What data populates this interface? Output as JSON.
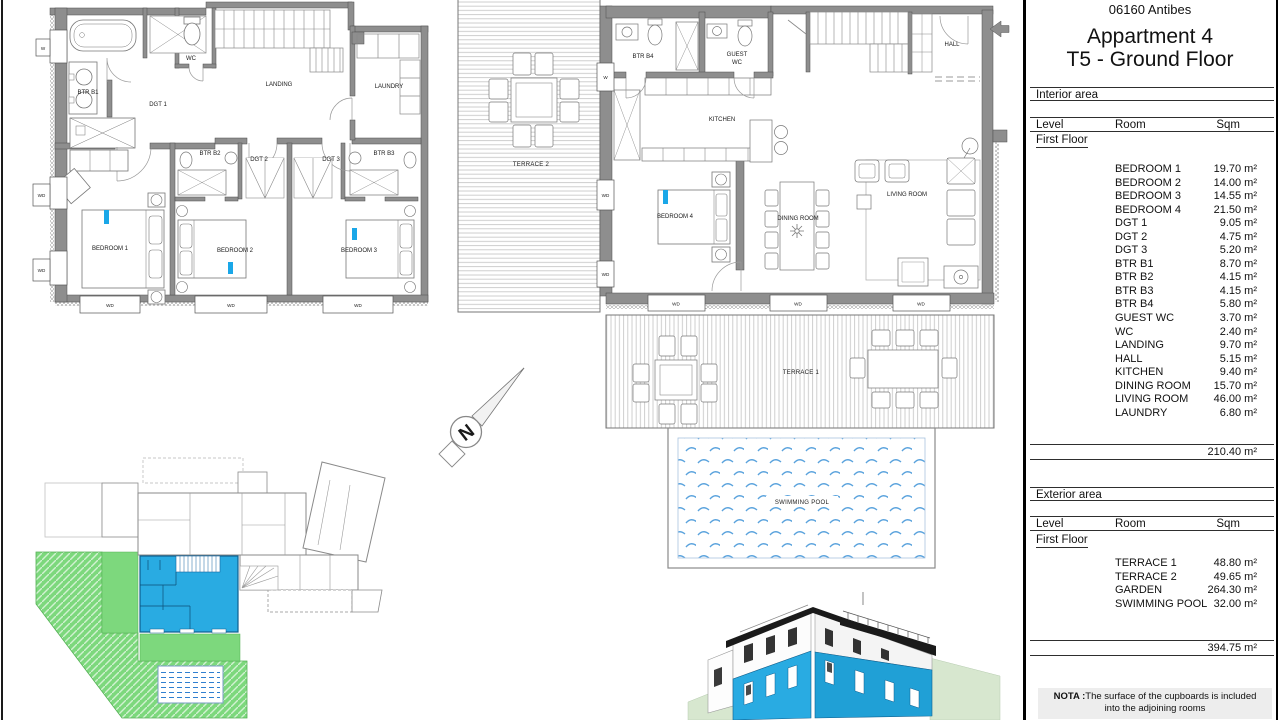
{
  "panel": {
    "location": "06160 Antibes",
    "title_line1": "Appartment 4",
    "title_line2": "T5 - Ground Floor",
    "interior": {
      "section": "Interior area",
      "columns": {
        "level": "Level",
        "room": "Room",
        "sqm": "Sqm"
      },
      "level": "First Floor",
      "rows": [
        {
          "room": "BEDROOM 1",
          "sqm": "19.70 m²"
        },
        {
          "room": "BEDROOM 2",
          "sqm": "14.00 m²"
        },
        {
          "room": "BEDROOM 3",
          "sqm": "14.55 m²"
        },
        {
          "room": "BEDROOM 4",
          "sqm": "21.50 m²"
        },
        {
          "room": "DGT 1",
          "sqm": "9.05 m²"
        },
        {
          "room": "DGT 2",
          "sqm": "4.75 m²"
        },
        {
          "room": "DGT 3",
          "sqm": "5.20 m²"
        },
        {
          "room": "BTR B1",
          "sqm": "8.70 m²"
        },
        {
          "room": "BTR B2",
          "sqm": "4.15 m²"
        },
        {
          "room": "BTR B3",
          "sqm": "4.15 m²"
        },
        {
          "room": "BTR B4",
          "sqm": "5.80 m²"
        },
        {
          "room": "GUEST WC",
          "sqm": "3.70 m²"
        },
        {
          "room": "WC",
          "sqm": "2.40 m²"
        },
        {
          "room": "LANDING",
          "sqm": "9.70 m²"
        },
        {
          "room": "HALL",
          "sqm": "5.15 m²"
        },
        {
          "room": "KITCHEN",
          "sqm": "9.40 m²"
        },
        {
          "room": "DINING ROOM",
          "sqm": "15.70 m²"
        },
        {
          "room": "LIVING ROOM",
          "sqm": "46.00 m²"
        },
        {
          "room": "LAUNDRY",
          "sqm": "6.80 m²"
        }
      ],
      "total": "210.40 m²"
    },
    "exterior": {
      "section": "Exterior area",
      "columns": {
        "level": "Level",
        "room": "Room",
        "sqm": "Sqm"
      },
      "level": "First Floor",
      "rows": [
        {
          "room": "TERRACE 1",
          "sqm": "48.80 m²"
        },
        {
          "room": "TERRACE 2",
          "sqm": "49.65 m²"
        },
        {
          "room": "GARDEN",
          "sqm": "264.30 m²"
        },
        {
          "room": "SWIMMING POOL",
          "sqm": "32.00 m²"
        }
      ],
      "total": "394.75 m²"
    },
    "nota": {
      "label": "NOTA :",
      "text": "The surface of the cupboards is included into the adjoining rooms"
    }
  },
  "plan_upper": {
    "btr_b1": "BTR B1",
    "wc": "WC",
    "landing": "LANDING",
    "laundry": "LAUNDRY",
    "dgt1": "DGT 1",
    "btr_b2": "BTR B2",
    "dgt2": "DGT 2",
    "dgt3": "DGT 3",
    "btr_b3": "BTR B3",
    "bedroom1": "BEDROOM 1",
    "bedroom2": "BEDROOM 2",
    "bedroom3": "BEDROOM 3"
  },
  "plan_main": {
    "terrace2": "TERRACE 2",
    "terrace1": "TERRACE 1",
    "btr_b4": "BTR B4",
    "guest_wc_1": "GUEST",
    "guest_wc_2": "WC",
    "kitchen": "KITCHEN",
    "hall": "HALL",
    "bedroom4": "BEDROOM 4",
    "dining": "DINING ROOM",
    "living": "LIVING ROOM",
    "pool": "SWIMMING POOL"
  },
  "labels": {
    "wd": "WD",
    "w": "W",
    "north": "N"
  },
  "colors": {
    "highlight_cyan": "#29abe2",
    "garden_green": "#7dd87d",
    "pool_blue": "#5ba3dd",
    "wall_gray": "#8e8e8e",
    "roof_black": "#1a1a1a"
  }
}
